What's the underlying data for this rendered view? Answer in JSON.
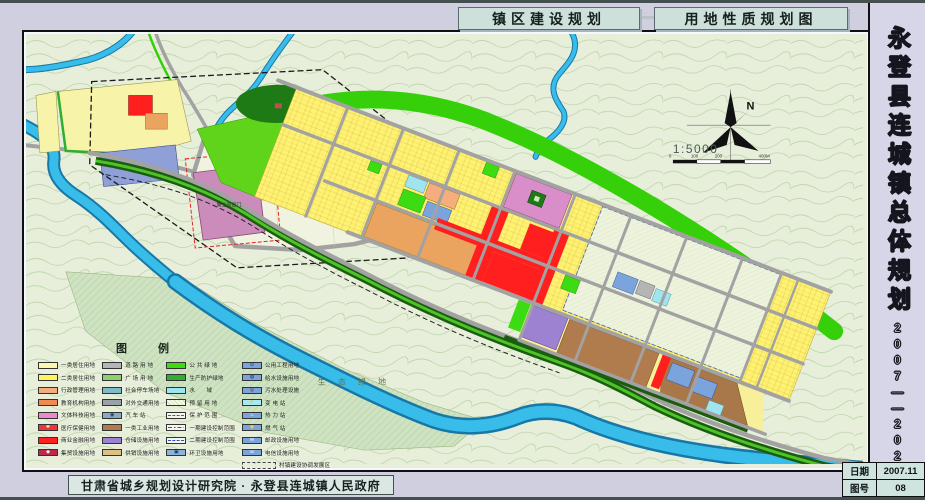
{
  "header": {
    "title_left": "镇区建设规划",
    "title_right": "用地性质规划图"
  },
  "sidebar": {
    "title_vertical": "永登县连城镇总体规划",
    "period": "2007——2020"
  },
  "titleblock": {
    "date_label": "日期",
    "date_value": "2007.11",
    "sheet_label": "图号",
    "sheet_value": "08"
  },
  "footer": {
    "credit": "甘肃省城乡规划设计研究院 · 永登县连城镇人民政府"
  },
  "map": {
    "labels": {
      "historic_site": "鲁土司衙门",
      "eco_green": "生 态 绿 地"
    },
    "compass": {
      "north": "N",
      "scale": "1:5000",
      "scalebar_ticks": [
        "0",
        "100",
        "200",
        "400M"
      ]
    }
  },
  "legend": {
    "title": "图  例",
    "columns": [
      [
        {
          "label": "一类居住用地",
          "color": "#fdf6ae",
          "type": "fill"
        },
        {
          "label": "二类居住用地",
          "color": "#fff35e",
          "type": "fill"
        },
        {
          "label": "行政管理用地",
          "color": "#f4ad7c",
          "type": "fill"
        },
        {
          "label": "教育机构用地",
          "color": "#ef8a50",
          "type": "fill"
        },
        {
          "label": "文体科技用地",
          "color": "#e78cc8",
          "type": "fill"
        },
        {
          "label": "医疗保健用地",
          "color": "#f23434",
          "type": "fill-glyph",
          "glyph": "✚",
          "glyph_color": "#ffffff"
        },
        {
          "label": "商业金融用地",
          "color": "#ff1f1f",
          "type": "fill"
        },
        {
          "label": "集贸设施用地",
          "color": "#bb2a4e",
          "type": "fill-glyph",
          "glyph": "◆",
          "glyph_color": "#ffffff"
        }
      ],
      [
        {
          "label": "道 路 用 地",
          "color": "#b5b5b5",
          "type": "fill"
        },
        {
          "label": "广 场 用 地",
          "color": "#8ed06e",
          "type": "fill"
        },
        {
          "label": "社会停车场地",
          "color": "#7fbcc8",
          "type": "fill"
        },
        {
          "label": "对外交通用地",
          "color": "#9aa1a8",
          "type": "fill"
        },
        {
          "label": "汽 车 站",
          "color": "#8ca9c4",
          "type": "fill-glyph",
          "glyph": "◉",
          "glyph_color": "#1a3a6a"
        },
        {
          "label": "一类工业用地",
          "color": "#b07c4e",
          "type": "fill"
        },
        {
          "label": "仓储设施用地",
          "color": "#9d82d2",
          "type": "fill"
        },
        {
          "label": "供销设施用地",
          "color": "#dcc088",
          "type": "fill"
        }
      ],
      [
        {
          "label": "公 共 绿 地",
          "color": "#3bdc12",
          "type": "fill"
        },
        {
          "label": "生产防护绿地",
          "color": "#2fae2f",
          "type": "fill"
        },
        {
          "label": "水　　域",
          "color": "#97e6f2",
          "type": "fill"
        },
        {
          "label": "预 留 用 地",
          "color": "#cfe0b8",
          "type": "hatch"
        },
        {
          "label": "保 护 范 围",
          "color": "#e82222",
          "type": "line-dash"
        },
        {
          "label": "一期建设控制范围",
          "color": "#2a52b8",
          "type": "line-dashdot"
        },
        {
          "label": "二期建设控制范围",
          "color": "#2a52b8",
          "type": "line-dash"
        },
        {
          "label": "环卫设施用地",
          "color": "#8fb2da",
          "type": "fill-glyph",
          "glyph": "▣",
          "glyph_color": "#123a6a"
        }
      ],
      [
        {
          "label": "公用工程用地",
          "color": "#7ba4dc",
          "type": "fill-glyph",
          "glyph": "⊙",
          "glyph_color": "#0a2a6a"
        },
        {
          "label": "给水设施用地",
          "color": "#7ba4dc",
          "type": "fill-glyph",
          "glyph": "◍",
          "glyph_color": "#0a2a6a"
        },
        {
          "label": "污水处理设施",
          "color": "#7ba4dc",
          "type": "fill-glyph",
          "glyph": "◎",
          "glyph_color": "#7a1a1a"
        },
        {
          "label": "变 电 站",
          "color": "#a8e8f2",
          "type": "fill-glyph",
          "glyph": "⚡",
          "glyph_color": "#c01818"
        },
        {
          "label": "热 力 站",
          "color": "#7ba4dc",
          "type": "fill-glyph",
          "glyph": "♨",
          "glyph_color": "#ffffff"
        },
        {
          "label": "燃 气 站",
          "color": "#7ba4dc",
          "type": "fill-glyph",
          "glyph": "◉",
          "glyph_color": "#ffd24a"
        },
        {
          "label": "邮政设施用地",
          "color": "#7ba4dc",
          "type": "fill-glyph",
          "glyph": "✉",
          "glyph_color": "#ffffff"
        },
        {
          "label": "电信设施用地",
          "color": "#7ba4dc",
          "type": "fill-glyph",
          "glyph": "☏",
          "glyph_color": "#ffffff"
        },
        {
          "label": "村镇建设协调发展区",
          "color": "#444444",
          "type": "outline-dash",
          "wide": true
        }
      ]
    ]
  },
  "palette": {
    "terrain": "#e7efdb",
    "contour": "#a5c38d",
    "water": "#38bdea",
    "water_dark": "#1777a6",
    "green_belt": "#35d00a",
    "green_bright": "#5fd41a",
    "green_dark": "#1e7a14",
    "tree_band": "#1c5c10",
    "tree_light": "#4cc428",
    "eco": "#cfe3c4",
    "road": "#a2a2a2",
    "block_yellow": "#fff171",
    "block_yellow_pale": "#f7ef9a",
    "resid1": "#f7f3a8",
    "admin_salmon": "#f4ad7c",
    "orange": "#eba45f",
    "red": "#ff1f1f",
    "pink": "#d98ec9",
    "yamen": "#cb8cbc",
    "purple": "#9d82d2",
    "brown": "#b07c4e",
    "brown2": "#a9784a",
    "blue": "#7ba4dc",
    "cyan": "#9fe4ef",
    "gray_block": "#b5b5b5",
    "pale": "#f0f3df",
    "reserve": "#eef3de",
    "blue_violet": "#8f9fd8",
    "green_pub": "#3bdc12"
  }
}
